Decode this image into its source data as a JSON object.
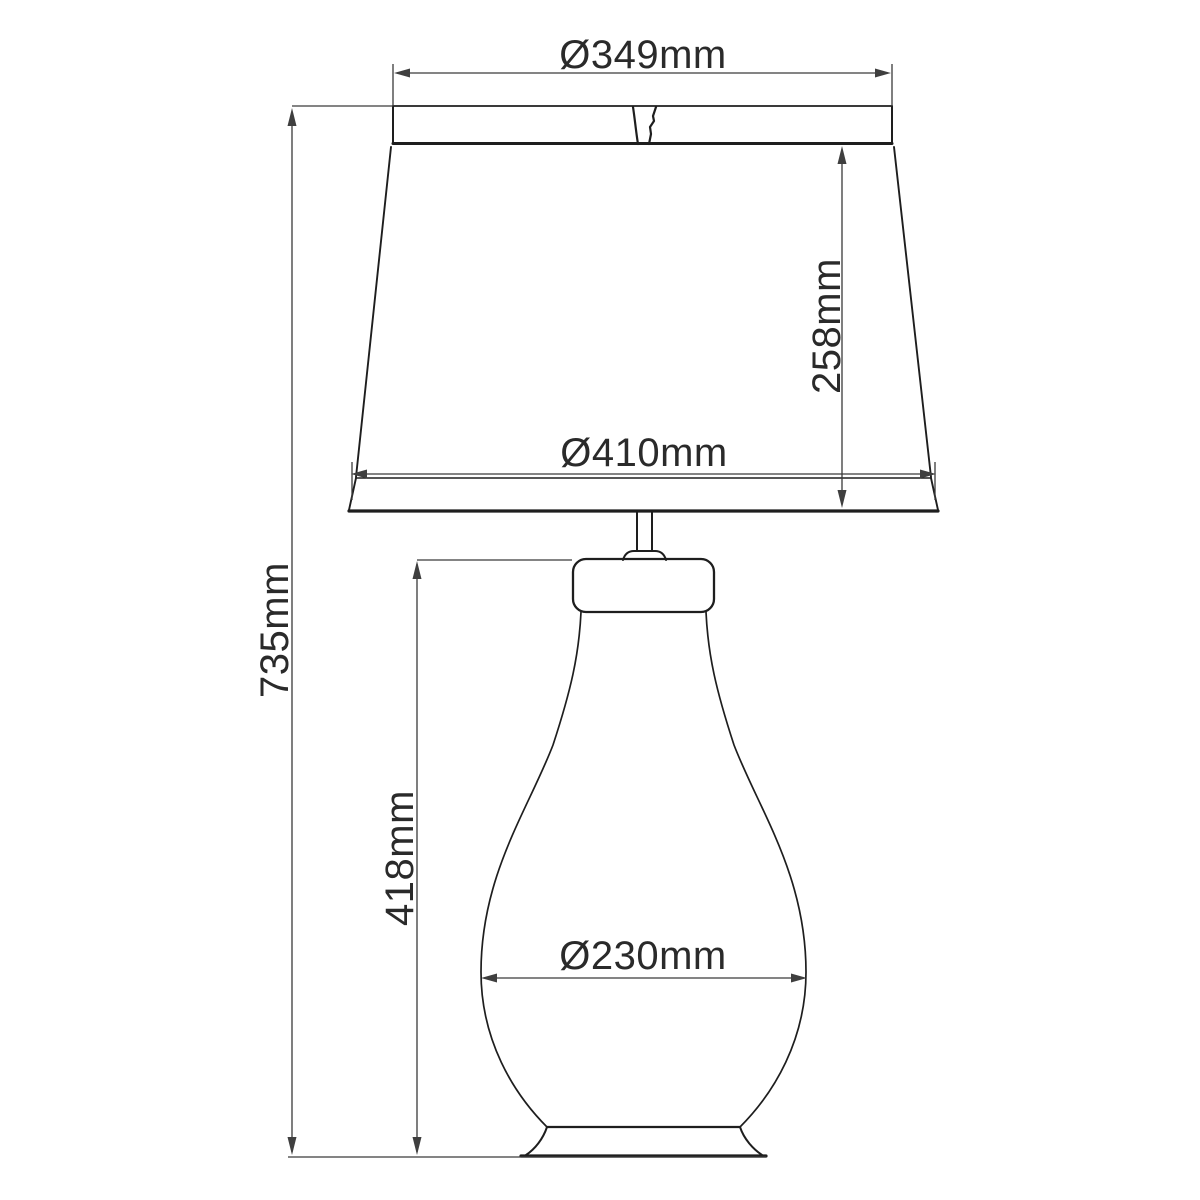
{
  "diagram": {
    "type": "technical-dimension-drawing",
    "subject": "table-lamp",
    "colors": {
      "background": "#ffffff",
      "line": "#1e1e1e",
      "dimension_line": "#3a3a3a",
      "text": "#2a2a2a"
    },
    "dimensions": {
      "shade_top_diameter": {
        "label": "Ø349mm",
        "orientation": "horizontal"
      },
      "shade_height": {
        "label": "258mm",
        "orientation": "vertical"
      },
      "shade_bottom_diameter": {
        "label": "Ø410mm",
        "orientation": "horizontal"
      },
      "total_height": {
        "label": "735mm",
        "orientation": "vertical"
      },
      "body_height": {
        "label": "418mm",
        "orientation": "vertical"
      },
      "body_diameter": {
        "label": "Ø230mm",
        "orientation": "horizontal"
      }
    }
  }
}
